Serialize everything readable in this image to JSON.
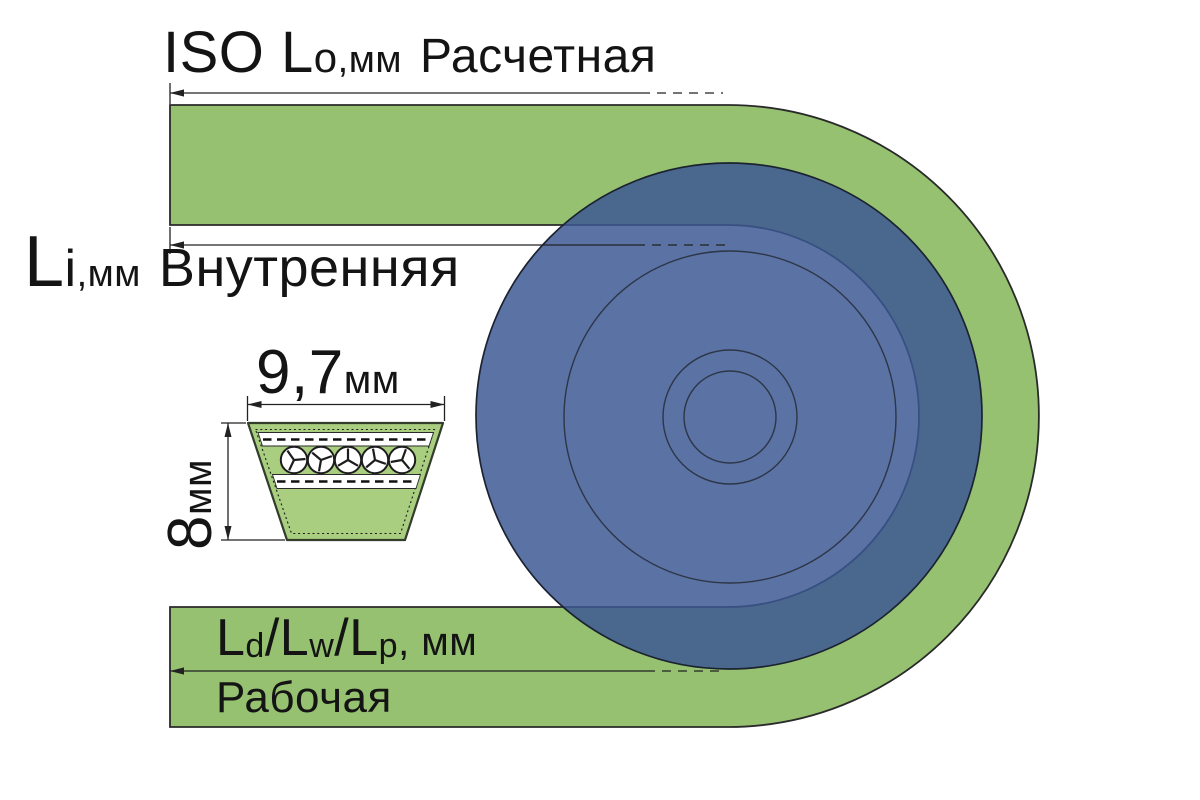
{
  "canvas": {
    "width": 1200,
    "height": 800
  },
  "labels": {
    "outer_length": {
      "prefix": "ISO L",
      "sub": "o",
      "units": ",мм",
      "name": "Расчетная"
    },
    "inner_length": {
      "prefix": "L",
      "sub": "i",
      "units": ",мм",
      "name": "Внутренняя"
    },
    "section_width": {
      "value": "9,7",
      "units": "мм"
    },
    "section_height": {
      "value": "8",
      "units": "мм"
    },
    "datum_length": {
      "p1": "L",
      "s1": "d",
      "sl1": "/",
      "p2": "L",
      "s2": "w",
      "sl2": "/",
      "p3": "L",
      "s3": "p",
      "units": ", мм",
      "name": "Рабочая"
    }
  },
  "colors": {
    "background": "#ffffff",
    "belt_green": "#95c171",
    "belt_outline": "#2a2a2a",
    "pulley_blue": "rgba(60,87,148,0.84)",
    "pulley_outline": "#1c2330",
    "groove_lines": "#262c36",
    "section_fill": "#a9ce80",
    "section_outline": "#333d2b",
    "cord_fill": "#ffffff",
    "dim_lines": "#222222",
    "text": "#141414"
  }
}
